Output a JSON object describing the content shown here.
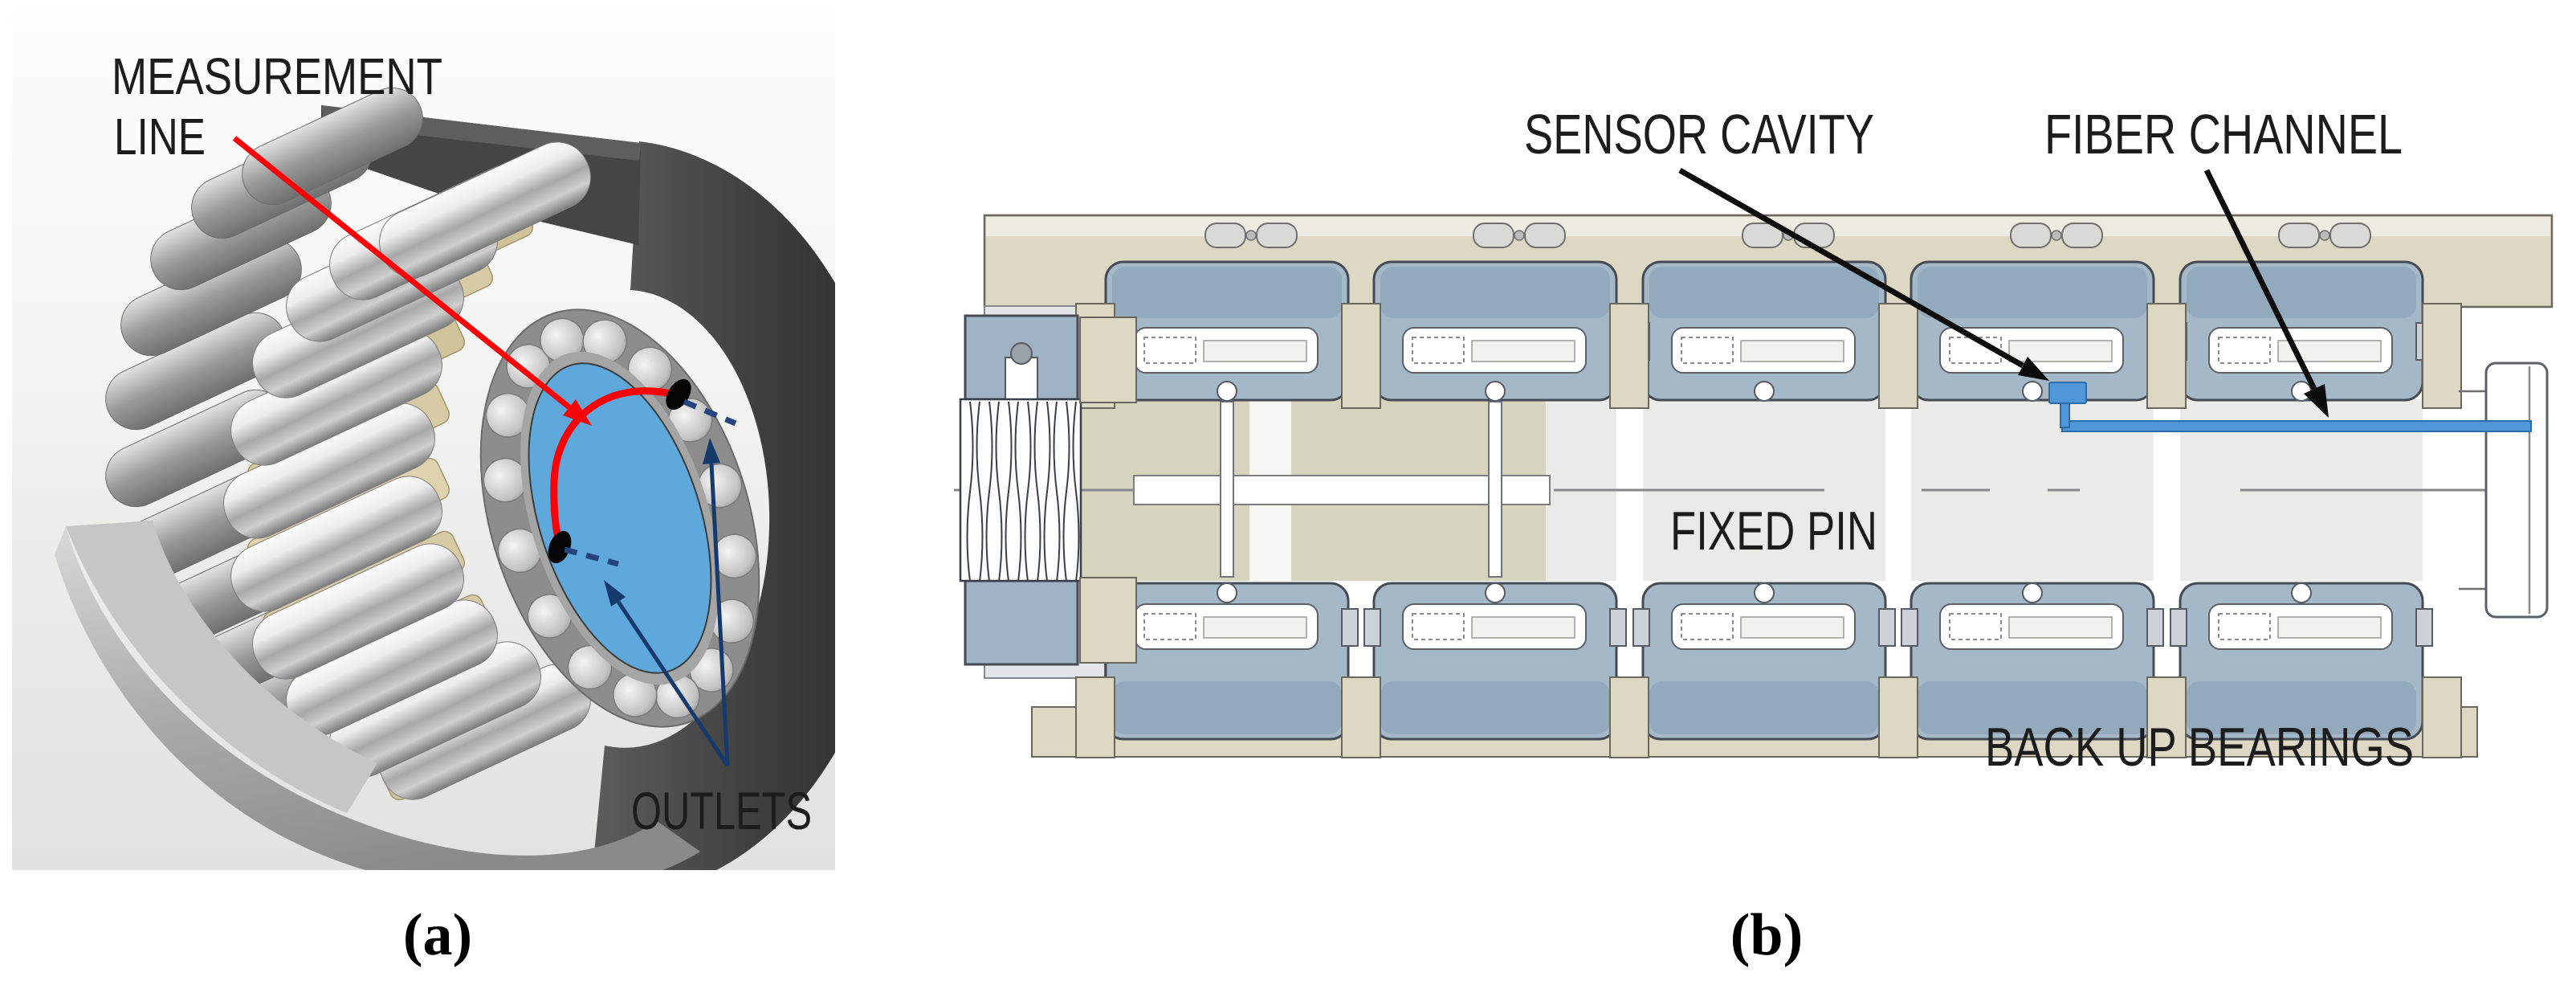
{
  "figure": {
    "panel_a": {
      "caption": "(a)",
      "label_measurement_1": "MEASUREMENT",
      "label_measurement_2": "LINE",
      "label_outlets": "OUTLETS",
      "colors": {
        "bore_blue": "#5fa8db",
        "measurement_red": "#f70406",
        "outlet_navy": "#173a6d"
      }
    },
    "panel_b": {
      "caption": "(b)",
      "label_sensor_cavity": "SENSOR CAVITY",
      "label_fiber_channel": "FIBER CHANNEL",
      "label_fixed_pin": "FIXED PIN",
      "label_back_up_bearings": "BACK UP BEARINGS",
      "colors": {
        "fiber_blue": "#4f97d9",
        "frame_beige": "#dcd8c3",
        "bearing_bluegray": "#a5b8c8"
      }
    }
  }
}
